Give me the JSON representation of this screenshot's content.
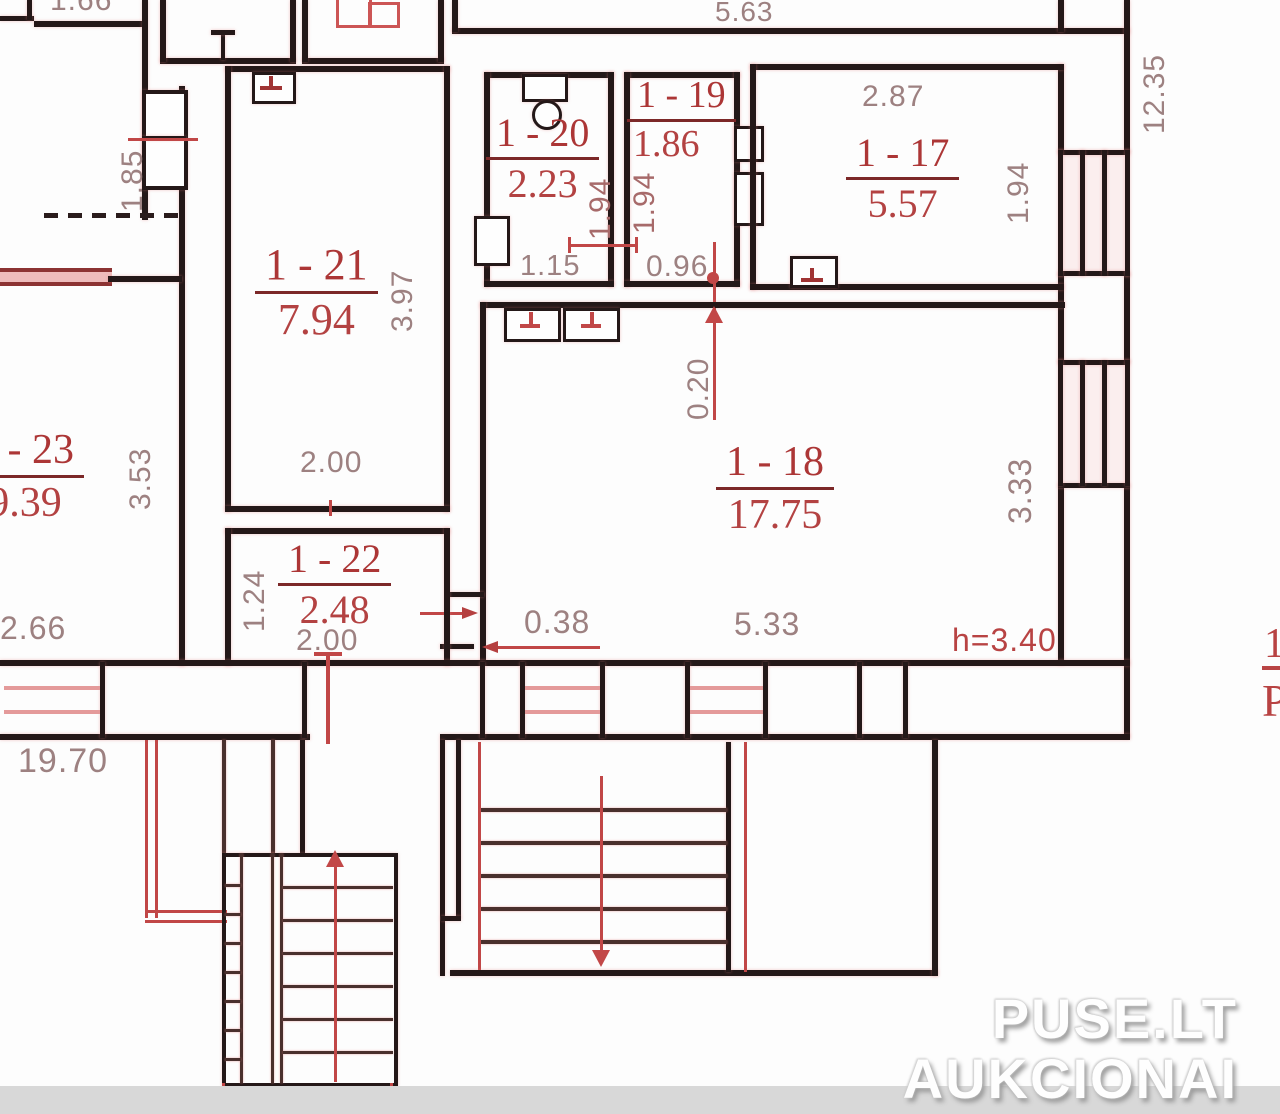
{
  "plan": {
    "rooms": {
      "r17": {
        "id": "1 - 17",
        "area": "5.57"
      },
      "r18": {
        "id": "1 - 18",
        "area": "17.75"
      },
      "r19": {
        "id": "1 - 19",
        "area": "1.86"
      },
      "r20": {
        "id": "1 - 20",
        "area": "2.23"
      },
      "r21": {
        "id": "1 - 21",
        "area": "7.94"
      },
      "r22": {
        "id": "1 - 22",
        "area": "2.48"
      },
      "r23": {
        "id": "1 - 23",
        "area": "9.39"
      }
    },
    "dimensions": {
      "top_width": "5.63",
      "right_height": "12.35",
      "corridor_width": "1.85",
      "r21_depth": "3.97",
      "r21_width": "2.00",
      "r20_width": "1.15",
      "r20_depth": "1.94",
      "r19_depth": "1.94",
      "r19_width": "0.96",
      "r17_width": "2.87",
      "r17_depth": "1.94",
      "r18_offset": "0.20",
      "r18_depth": "3.33",
      "r18_width": "5.33",
      "ceiling_height": "h=3.40",
      "hall_width": "0.38",
      "r22_depth": "1.24",
      "r22_width": "2.00",
      "r23_depth": "3.53",
      "r23_width": "2.66",
      "total_width": "19.70"
    },
    "fragments": {
      "top_left": "1.66",
      "right_line1": "1",
      "right_line2": "P"
    }
  },
  "watermark": {
    "line1": "PUSE.LT",
    "line2": "AUKCIONAI"
  }
}
